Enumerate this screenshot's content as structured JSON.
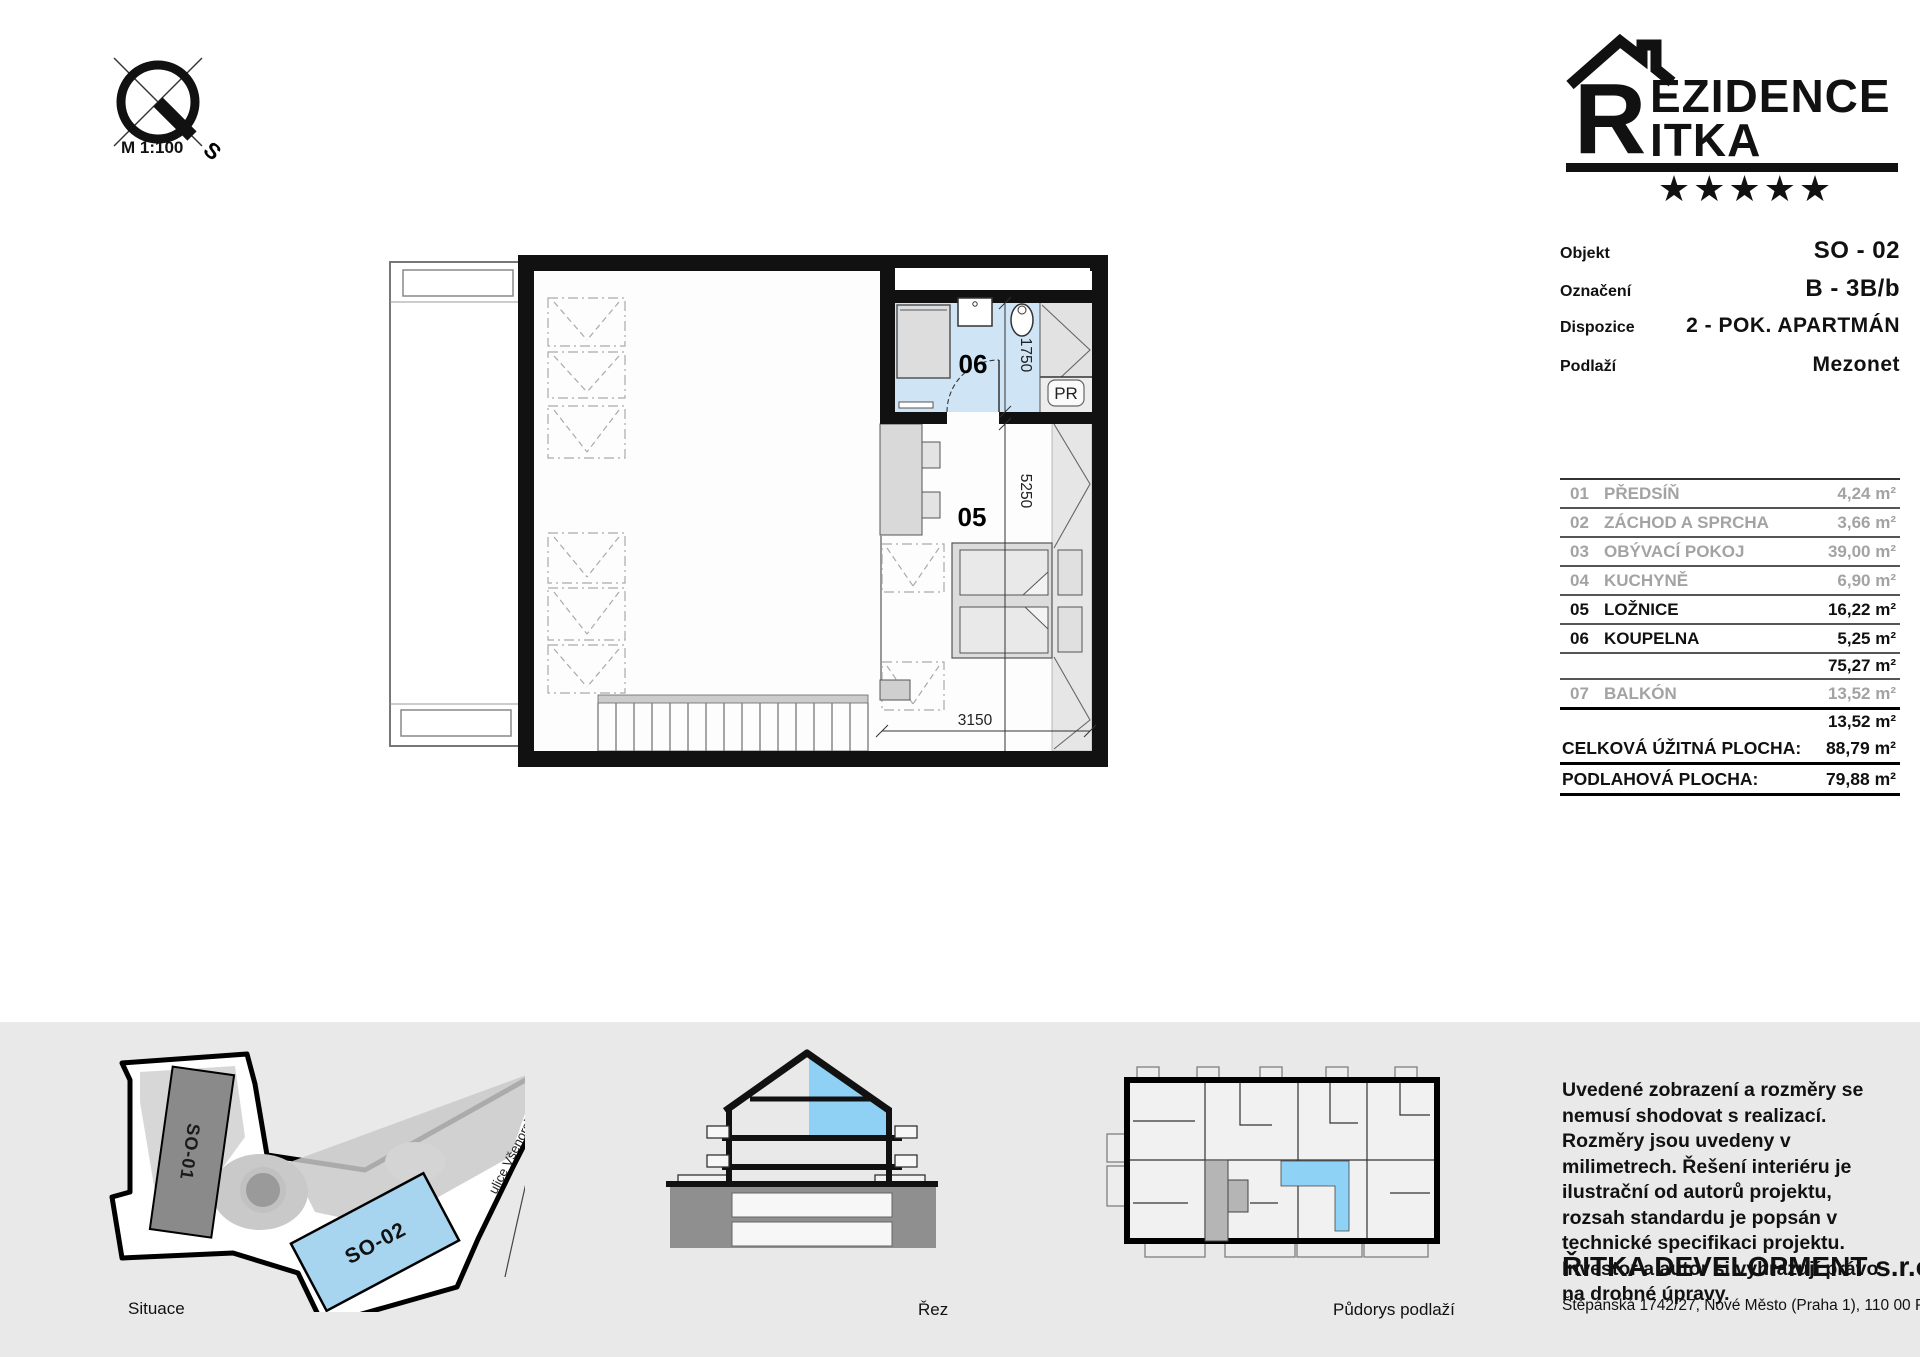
{
  "page": {
    "scale": "M 1:100"
  },
  "compass": {
    "south": "S"
  },
  "logo": {
    "r": "R",
    "line1": "EZIDENCE",
    "line2": "ITKA",
    "stars": "★★★★★"
  },
  "info": {
    "objekt_label": "Objekt",
    "objekt_value": "SO - 02",
    "oznaceni_label": "Označení",
    "oznaceni_value": "B - 3B/b",
    "dispozice_label": "Dispozice",
    "dispozice_value": "2 - POK. APARTMÁN",
    "podlazi_label": "Podlaží",
    "podlazi_value": "Mezonet"
  },
  "rooms": {
    "rows": [
      {
        "num": "01",
        "name": "PŘEDSÍŇ",
        "area": "4,24 m²"
      },
      {
        "num": "02",
        "name": "ZÁCHOD A SPRCHA",
        "area": "3,66 m²"
      },
      {
        "num": "03",
        "name": "OBÝVACÍ POKOJ",
        "area": "39,00 m²"
      },
      {
        "num": "04",
        "name": "KUCHYNĚ",
        "area": "6,90 m²"
      },
      {
        "num": "05",
        "name": "LOŽNICE",
        "area": "16,22 m²"
      },
      {
        "num": "06",
        "name": "KOUPELNA",
        "area": "5,25 m²"
      }
    ],
    "subtotal_interior": "75,27 m²",
    "balcony": {
      "num": "07",
      "name": "BALKÓN",
      "area": "13,52 m²"
    },
    "subtotal_balcony": "13,52 m²",
    "total_label": "CELKOVÁ ÚŽITNÁ PLOCHA:",
    "total_value": "88,79 m²",
    "floor_label": "PODLAHOVÁ PLOCHA:",
    "floor_value": "79,88 m²"
  },
  "plan": {
    "room05": "05",
    "room06": "06",
    "pr": "PR",
    "dim_bath": "1750",
    "dim_bedroom": "5250",
    "dim_width": "3150"
  },
  "site": {
    "so01": "SO-01",
    "so02": "SO-02",
    "street": "ulice Všenorská",
    "caption": "Situace"
  },
  "section": {
    "caption": "Řez"
  },
  "floorplan_small": {
    "caption": "Půdorys podlaží"
  },
  "disclaimer": "Uvedené zobrazení a rozměry se nemusí shodovat s realizací. Rozměry jsou uvedeny v milimetrech. Řešení interiéru je ilustrační od autorů projektu, rozsah standardu je popsán v technické specifikaci projektu. Investor a autor si vyhrazují právo na drobné úpravy.",
  "company": {
    "name": "ŘITKA DEVELOPMENT s.r.o.",
    "address": "Štěpánská 1742/27, Nové Město (Praha 1), 110 00 Praha"
  },
  "colors": {
    "highlight_blue": "#cfe4f4",
    "section_blue": "#8fd0f5",
    "site_blue": "#a7d4ee",
    "unit_blue": "#8ed2f5",
    "panel_gray": "#e9e9e9"
  }
}
